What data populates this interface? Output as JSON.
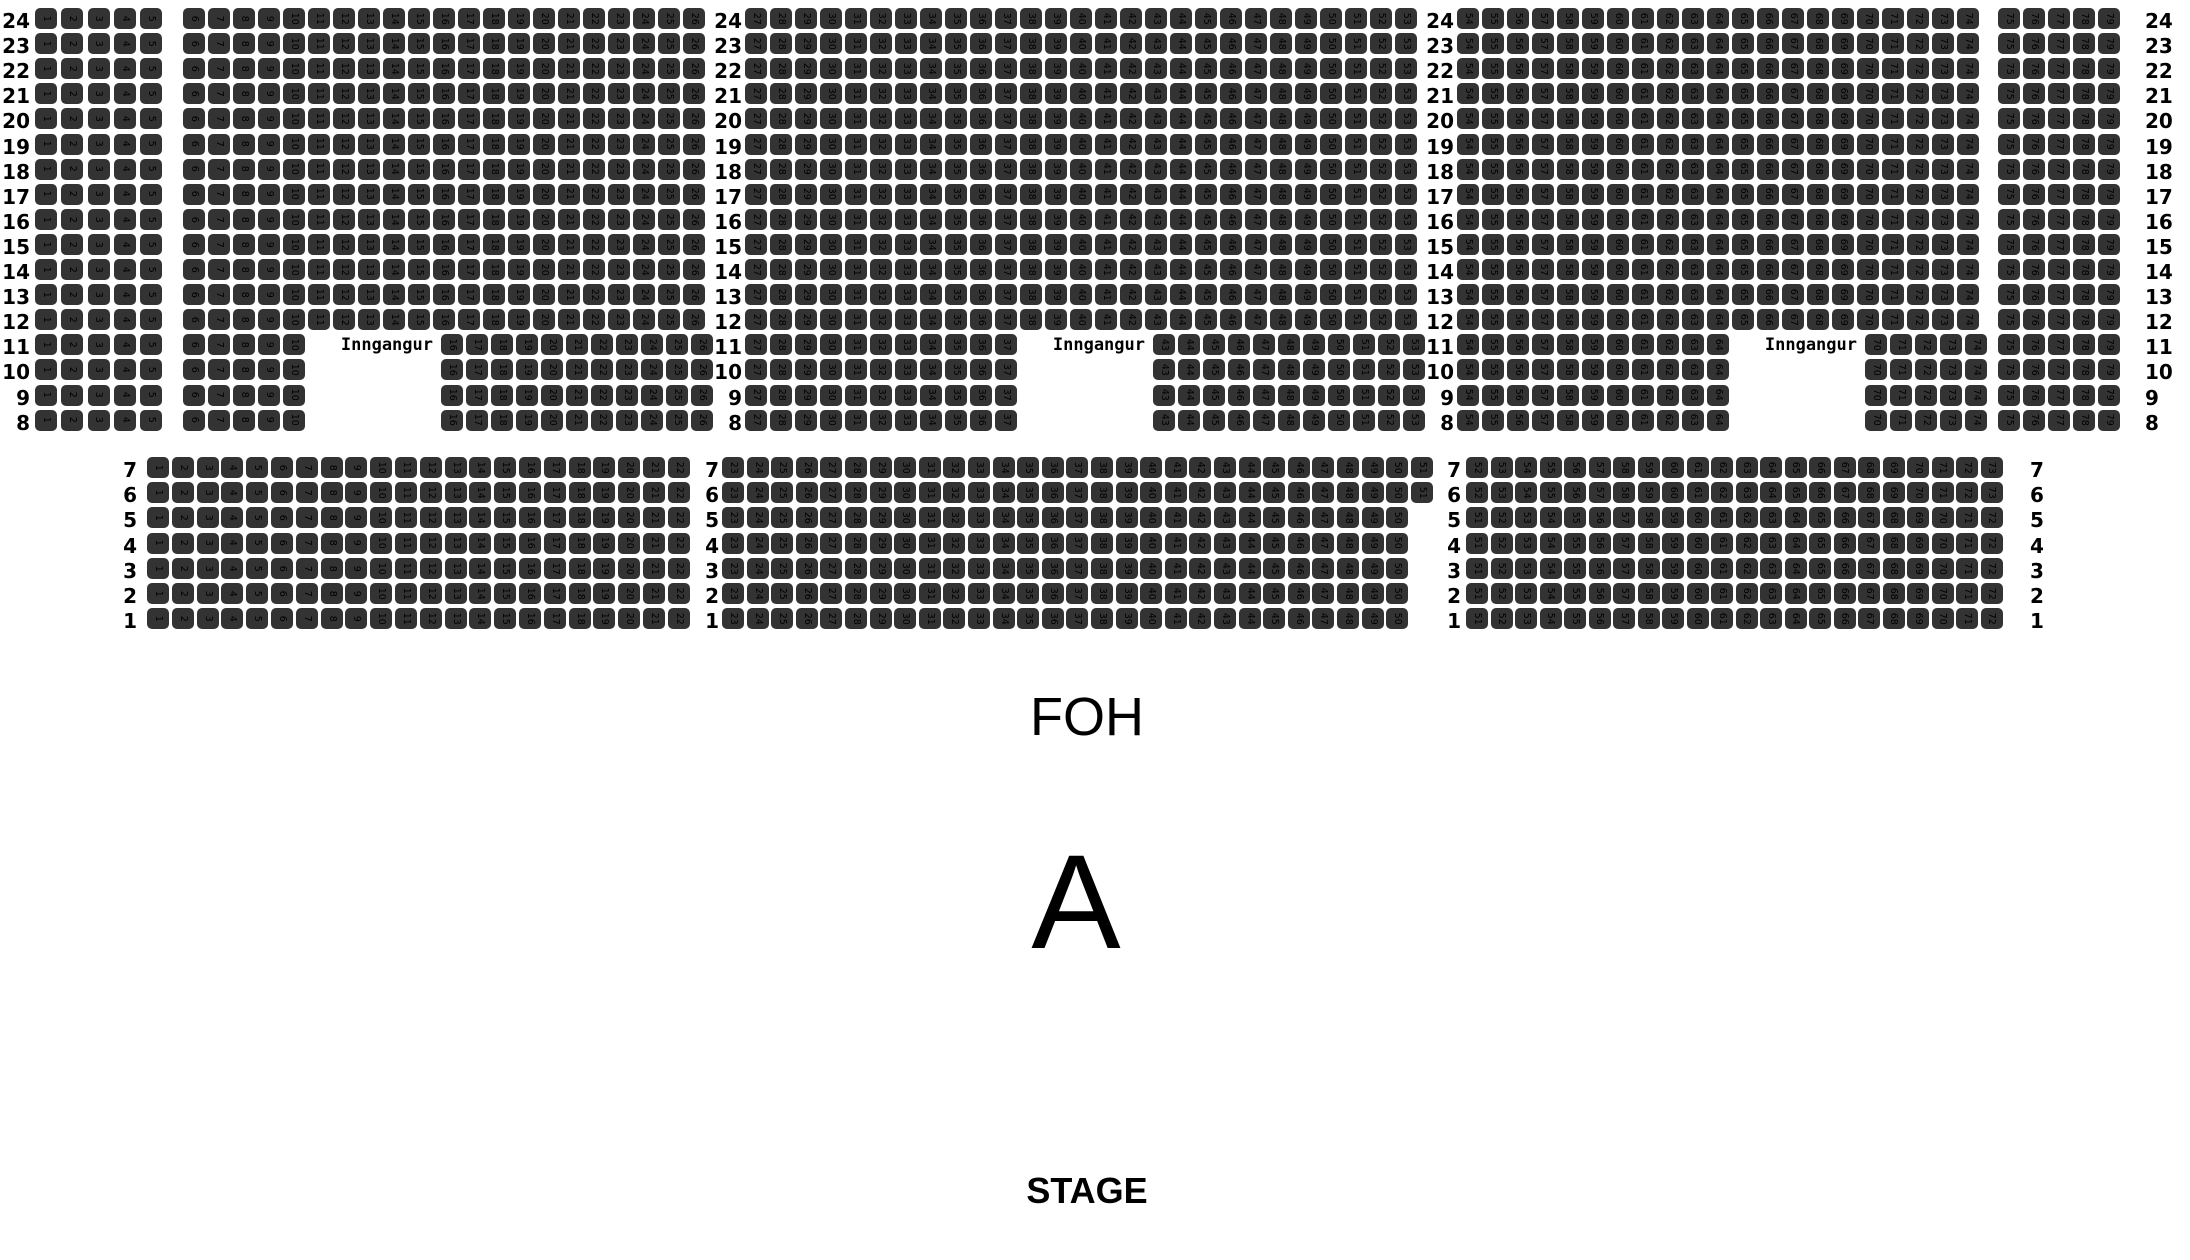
{
  "labels": {
    "foh": "FOH",
    "section": "A",
    "stage": "STAGE"
  },
  "entrance_label": "Inngangur",
  "colors": {
    "background": "#ffffff",
    "seat_fill": "#333333",
    "seat_number_text": "#000000",
    "label_text": "#000000"
  },
  "upper_section": {
    "rows_from": 24,
    "rows_to": 8,
    "gap_rows": [
      11,
      10,
      9,
      8
    ],
    "gap_right_shift": 8,
    "row_top": 8,
    "row_pitch": 25.1,
    "blocks": [
      {
        "id": "A",
        "seats_from": 1,
        "seats_to": 5,
        "x": 35,
        "pitch": 26.25
      },
      {
        "id": "B",
        "seats_from": 6,
        "seats_to": 26,
        "x": 183,
        "pitch": 25,
        "missing_from": 11,
        "missing_to": 15,
        "entrance": true
      },
      {
        "id": "C",
        "seats_from": 27,
        "seats_to": 53,
        "x": 745,
        "pitch": 25,
        "missing_from": 38,
        "missing_to": 42,
        "entrance": true
      },
      {
        "id": "D",
        "seats_from": 54,
        "seats_to": 74,
        "x": 1457,
        "pitch": 25,
        "missing_from": 65,
        "missing_to": 69,
        "entrance": true
      },
      {
        "id": "E",
        "seats_from": 75,
        "seats_to": 79,
        "x": 1998,
        "pitch": 25
      }
    ],
    "label_columns": [
      {
        "x": 30,
        "anchor": "right"
      },
      {
        "x": 742,
        "anchor": "right"
      },
      {
        "x": 1454,
        "anchor": "right"
      },
      {
        "x": 2145,
        "anchor": "left"
      }
    ],
    "entrance_row": 11
  },
  "lower_section": {
    "rows_from": 7,
    "rows_to": 1,
    "row_top": 457,
    "row_pitch": 25.2,
    "blocks": [
      {
        "id": "L1",
        "x": 147,
        "pitch": 24.8,
        "rows_7_6": {
          "from": 1,
          "to": 22
        },
        "rows_5_1": {
          "from": 1,
          "to": 22
        }
      },
      {
        "id": "L2",
        "x": 722,
        "pitch": 24.6,
        "rows_7_6": {
          "from": 23,
          "to": 51
        },
        "rows_5_1": {
          "from": 23,
          "to": 50
        }
      },
      {
        "id": "L3",
        "x": 1466,
        "pitch": 24.5,
        "rows_7_6": {
          "from": 52,
          "to": 73
        },
        "rows_5_1": {
          "from": 51,
          "to": 72
        }
      }
    ],
    "label_columns": [
      {
        "x": 137,
        "anchor": "right"
      },
      {
        "x": 719,
        "anchor": "right"
      },
      {
        "x": 1461,
        "anchor": "right"
      },
      {
        "x": 2030,
        "anchor": "left"
      }
    ]
  },
  "texts_layout": {
    "foh": {
      "cx": 1087,
      "top": 690
    },
    "section": {
      "cx": 1076,
      "top": 836
    },
    "stage": {
      "cx": 1087,
      "top": 1173
    },
    "label_y_offset": 3
  }
}
